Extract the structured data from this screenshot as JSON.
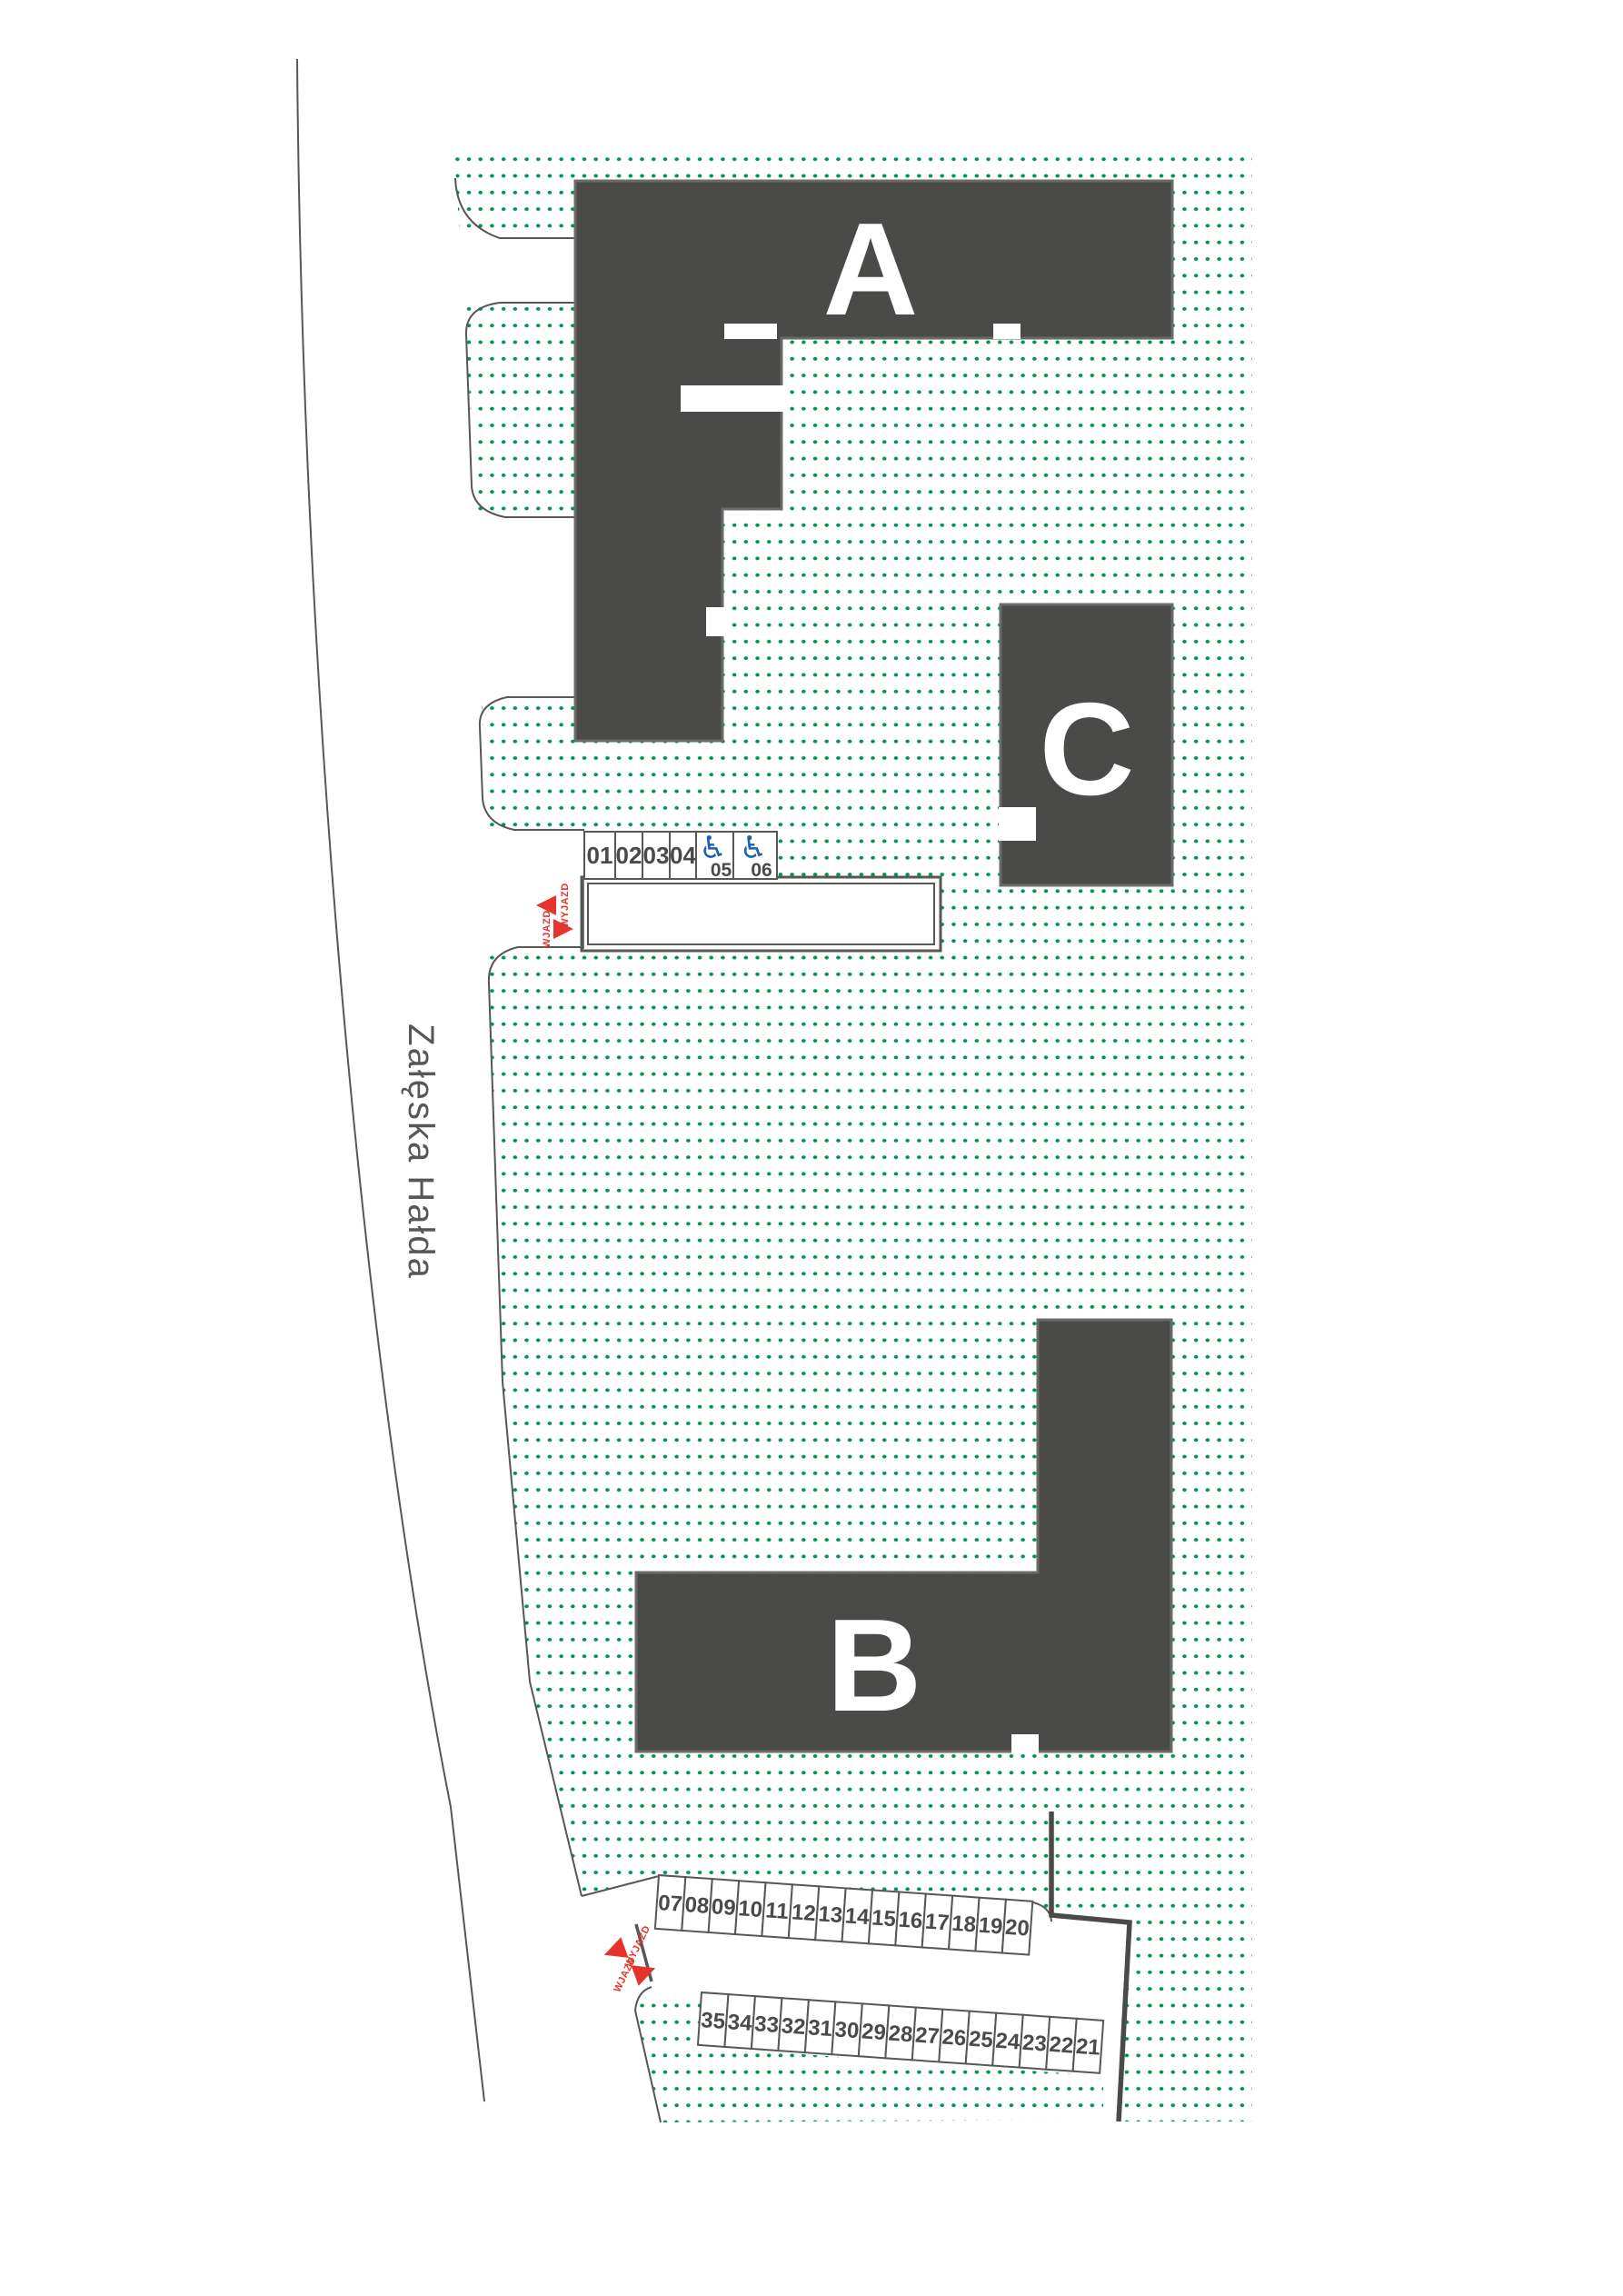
{
  "plan": {
    "street": {
      "name": "Załęska Hałda"
    },
    "buildings": [
      {
        "id": "a",
        "label": "A"
      },
      {
        "id": "b",
        "label": "B"
      },
      {
        "id": "c",
        "label": "C"
      }
    ],
    "entrances": {
      "exit_label": "WYJAZD",
      "entry_label": "WJAZD"
    },
    "parking": {
      "top_row": [
        "01",
        "02",
        "03",
        "04",
        "05",
        "06"
      ],
      "disabled_spots": [
        "05",
        "06"
      ],
      "middle_row": [
        "07",
        "08",
        "09",
        "10",
        "11",
        "12",
        "13",
        "14",
        "15",
        "16",
        "17",
        "18",
        "19",
        "20"
      ],
      "bottom_row": [
        "35",
        "34",
        "33",
        "32",
        "31",
        "30",
        "29",
        "28",
        "27",
        "26",
        "25",
        "24",
        "23",
        "22",
        "21"
      ]
    },
    "icons": {
      "wheelchair": "♿"
    },
    "colors": {
      "green": "#00924E",
      "building": "#4A4A49",
      "line": "#575756",
      "red": "#E5342B",
      "blue": "#1A61AB",
      "white": "#FFFFFF"
    }
  }
}
